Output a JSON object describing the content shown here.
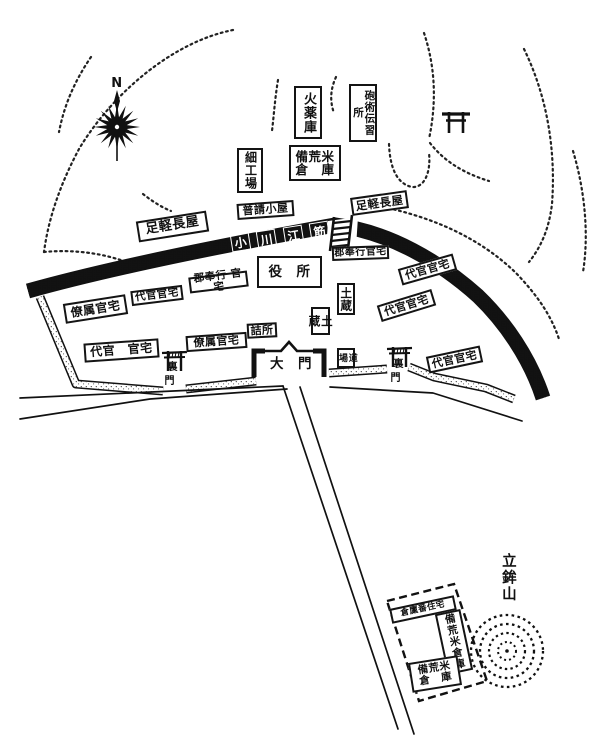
{
  "map": {
    "colors": {
      "ink": "#111111",
      "paper": "#ffffff"
    },
    "compass_north": "N",
    "mountain_label": "立鉾山",
    "river_label_chars": [
      "小",
      "川",
      "江",
      "筋"
    ],
    "buildings": {
      "kayakugura": "火薬庫",
      "hojutsu_denshujo": "砲術伝習所",
      "saikuba": "細工場",
      "bikomai_soko_top": "備荒米\n倉　庫",
      "ashigaru_nagaya_right": "足軽長屋",
      "fushin_goya": "普請小屋",
      "ashigaru_nagaya_left": "足軽長屋",
      "gunbugyo_kantaku_right": "郡奉行官宅",
      "yakusho": "役　所",
      "daikan_kantaku_ne": "代官官宅",
      "gunbugyo_kantaku_left": "郡奉行 官宅",
      "daikan_kantaku_nw": "代官官宅",
      "ryozoku_kantaku_upper": "僚属官宅",
      "dozo_upper": "土蔵",
      "daikan_kantaku_mid": "代官官宅",
      "dozo_lower": "土蔵",
      "daikan_kantaku_sw": "代官　官宅",
      "ryozoku_kantaku_lower": "僚属官宅",
      "tsumesho": "詰所",
      "dojo": "道場",
      "daikan_kantaku_se": "代官官宅",
      "kuraban_jutaku": "倉廩番住宅",
      "bikomai_soko_right": "備荒米倉庫",
      "bikomai_soko_bottom": "備荒米\n倉　庫"
    },
    "gates": {
      "main_gate": "大　門",
      "rear_gate_top": "裏",
      "rear_gate_bottom": "門"
    }
  }
}
